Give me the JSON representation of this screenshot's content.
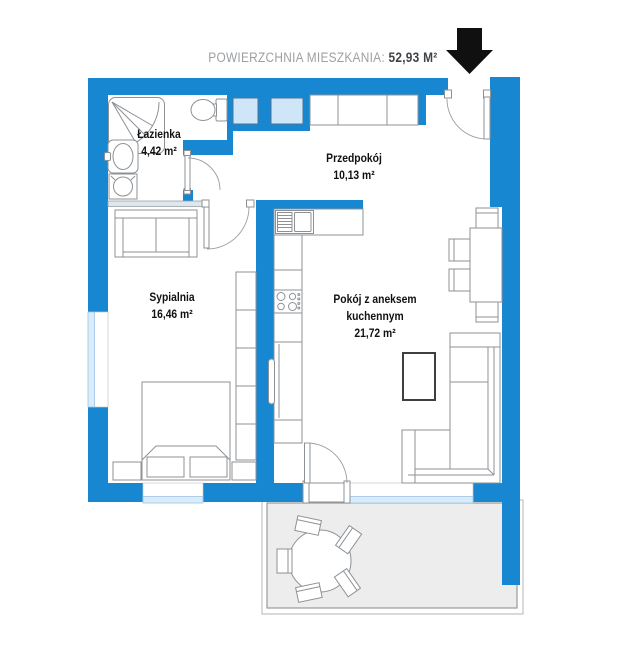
{
  "title": {
    "label": "POWIERZCHNIA MIESZKANIA:",
    "value": " 52,93 M²"
  },
  "rooms": [
    {
      "id": "lazienka",
      "name": "Łazienka",
      "area": "4,42 m²"
    },
    {
      "id": "przedpokoj",
      "name": "Przedpokój",
      "area": "10,13 m²"
    },
    {
      "id": "sypialnia",
      "name": "Sypialnia",
      "area": "16,46 m²"
    },
    {
      "id": "pokoj",
      "name_line1": "Pokój z aneksem",
      "name_line2": "kuchennym",
      "area": "21,72 m²"
    }
  ],
  "icons": {
    "entrance_arrow": "down-arrow"
  },
  "colors": {
    "wall": "#1787d2",
    "window": "#cfe6f8",
    "sill": "#d9ecfb",
    "terrace": "#ededed",
    "furniture": "#8c9196",
    "arrow": "#101010",
    "label": "#101112",
    "title_label": "#9da0a3",
    "title_value": "#3f4246"
  }
}
